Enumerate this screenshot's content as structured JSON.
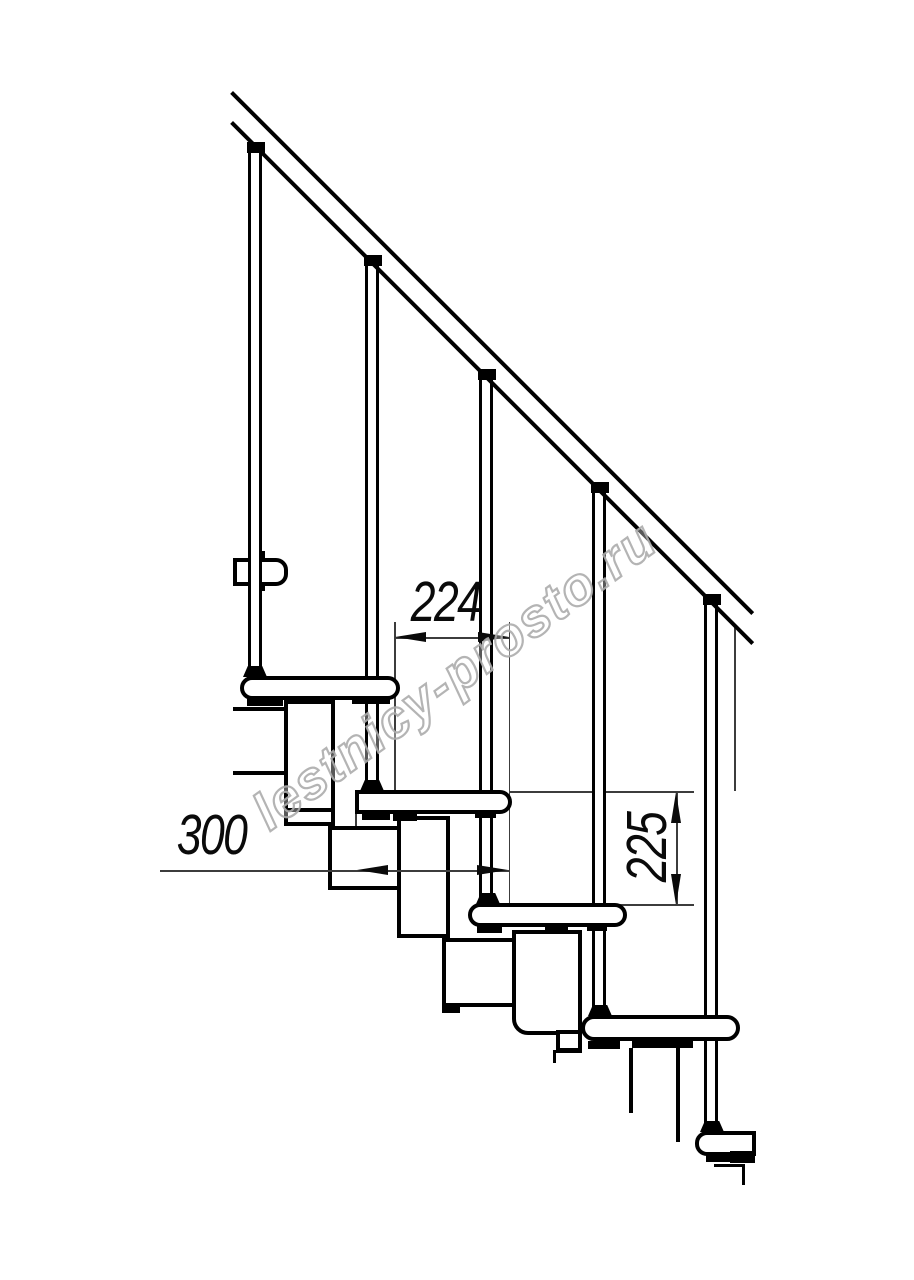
{
  "drawing": {
    "title": "staircase-side-elevation",
    "watermark": {
      "text": "lestnicy-prosto.ru",
      "color": "#acacac"
    },
    "dimensions": {
      "run": {
        "value": "224"
      },
      "depth": {
        "value": "300"
      },
      "rise": {
        "value": "225"
      }
    },
    "colors": {
      "background": "#ffffff",
      "line": "#000000",
      "thin_line": "#3c3c3c"
    }
  }
}
